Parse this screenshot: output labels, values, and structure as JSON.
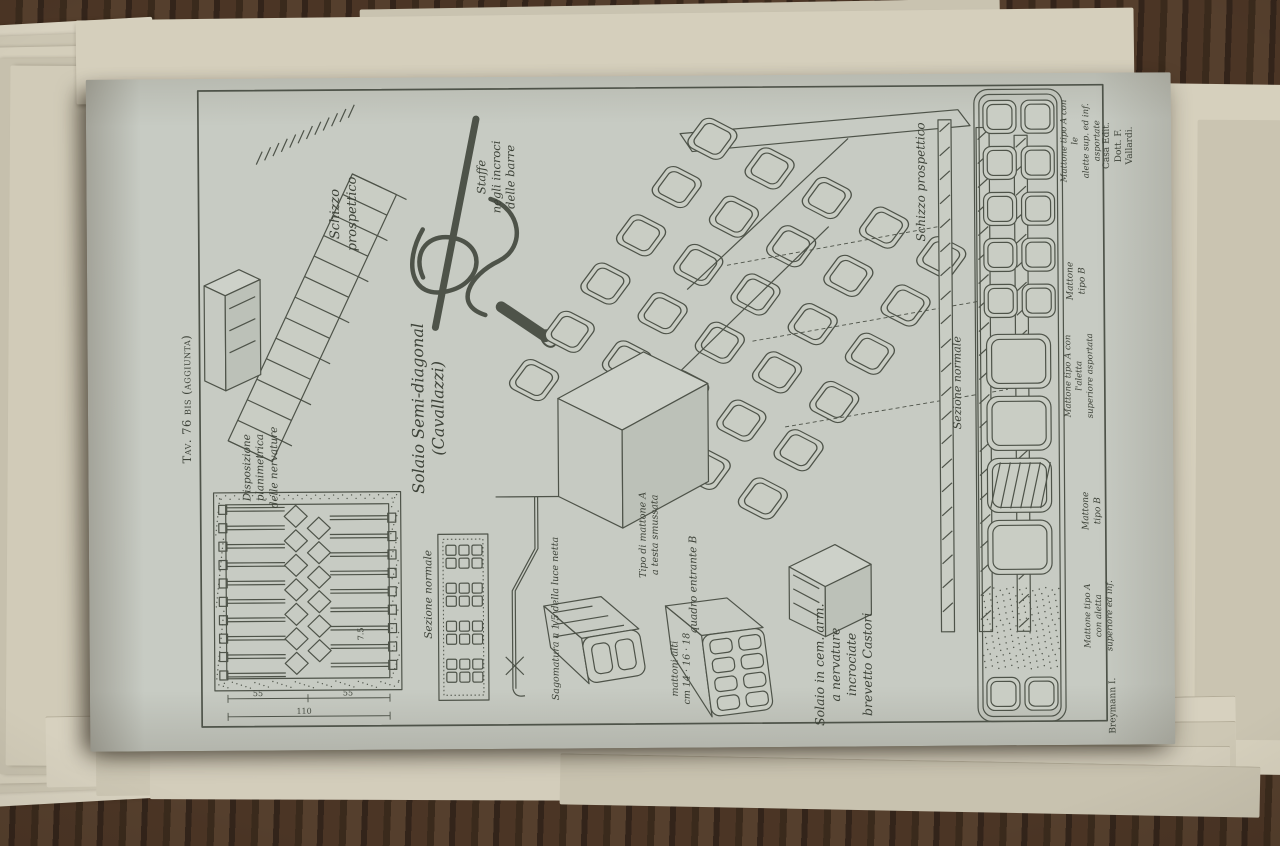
{
  "plate": {
    "number": "Tav. 76 bis (aggiunta)",
    "publisher": "Casa Edit. Dott. F. Vallardi.",
    "author_mark": "Breymann I.",
    "cavallazzi": {
      "title": "Solaio Semi-diagonal\n(Cavallazzi)",
      "schizzo": "Schizzo\nprospettico",
      "staffe": "Staffe\nnegli incroci\ndelle barre",
      "disposizione": "Disposizione\nplanimetrica\ndelle nervature",
      "sezione": "Sezione normale",
      "sagomatura": "Sagomatura a 1/5 della luce netta",
      "tipo_a": "Tipo di mattone A\na testa smussata",
      "quadro_b": "quadro entrante B",
      "mattoni": "mattoni alti\ncm 14 · 16 · 18",
      "dims": {
        "half_left": "55",
        "half_right": "55",
        "total": "110",
        "pitch": "7.5"
      }
    },
    "castori": {
      "title": "Solaio in cem. arm.\na nervature\nincrociate\nbrevetto Castori",
      "schizzo": "Schizzo prospettico",
      "sezione": "Sezione normale",
      "mattone_a_1": "Mattone tipo A con le\nalette sup. ed inf. asportate",
      "mattone_b_1": "Mattone\ntipo B",
      "mattone_a_2": "Mattone tipo A con l'aletta\nsuperiore asportata",
      "mattone_b_2": "Mattone\ntipo B",
      "mattone_a_3": "Mattone tipo A\ncon aletta superiore ed inf."
    }
  },
  "colors": {
    "plate_paper": "#c7cbc3",
    "ink": "#4e5349",
    "label_ink": "#3d4238",
    "under_pages": "#d6d0bf",
    "wood": "#43301f"
  }
}
